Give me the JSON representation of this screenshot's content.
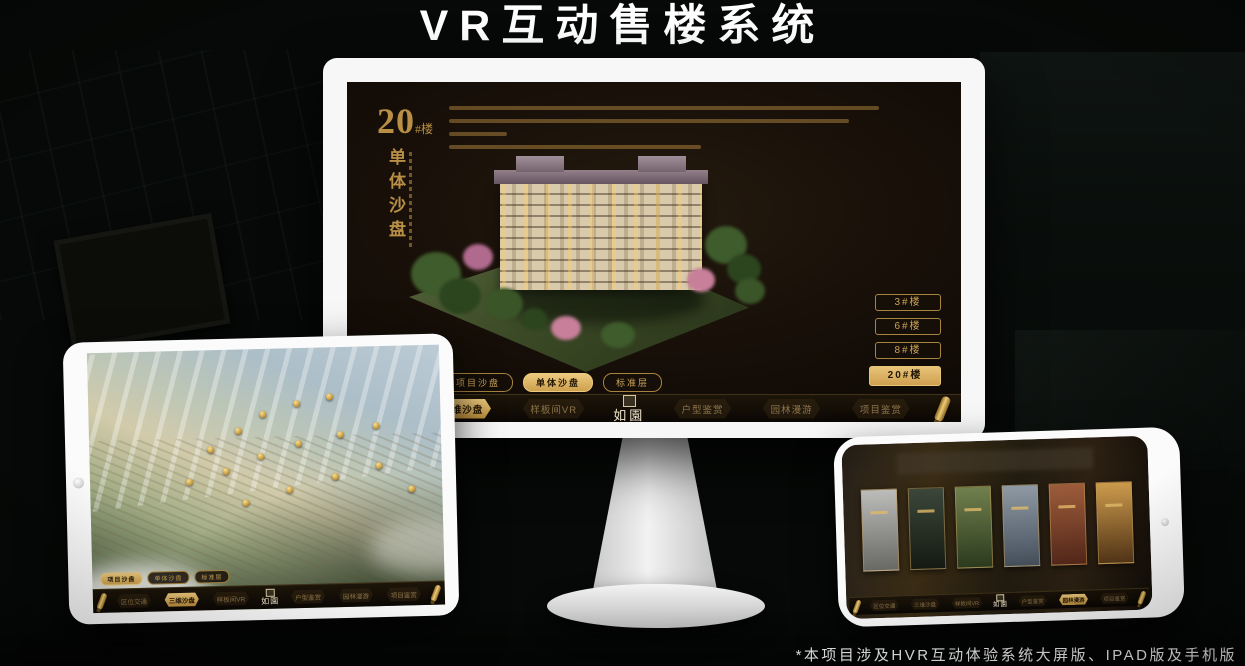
{
  "header": {
    "title": "VR互动售楼系统"
  },
  "footnote": "*本项目涉及HVR互动体验系统大屏版、IPAD版及手机版",
  "app": {
    "logo_text": "如園",
    "nav_items": [
      {
        "label": "区位交通"
      },
      {
        "label": "三维沙盘"
      },
      {
        "label": "样板间VR"
      },
      {
        "label": "户型鉴赏"
      },
      {
        "label": "园林漫游"
      },
      {
        "label": "项目鉴赏"
      }
    ],
    "sub_tabs": [
      {
        "label": "项目沙盘"
      },
      {
        "label": "单体沙盘"
      },
      {
        "label": "标准层"
      }
    ]
  },
  "monitor_screen": {
    "headline_number": "20",
    "headline_suffix": "#楼",
    "vertical_title": "单体沙盘",
    "active_nav": "三维沙盘",
    "active_sub_tab": "单体沙盘",
    "floor_buttons": [
      {
        "label": "3#楼",
        "active": false
      },
      {
        "label": "6#楼",
        "active": false
      },
      {
        "label": "8#楼",
        "active": false
      },
      {
        "label": "20#楼",
        "active": true
      }
    ]
  },
  "ipad_screen": {
    "active_nav": "三维沙盘",
    "active_sub_tab": "项目沙盘"
  },
  "phone_screen": {
    "active_nav": "园林漫游"
  },
  "colors": {
    "gold": "#c9a45a",
    "gold_active": "#ddb264",
    "screen_brown": "#17110a"
  }
}
